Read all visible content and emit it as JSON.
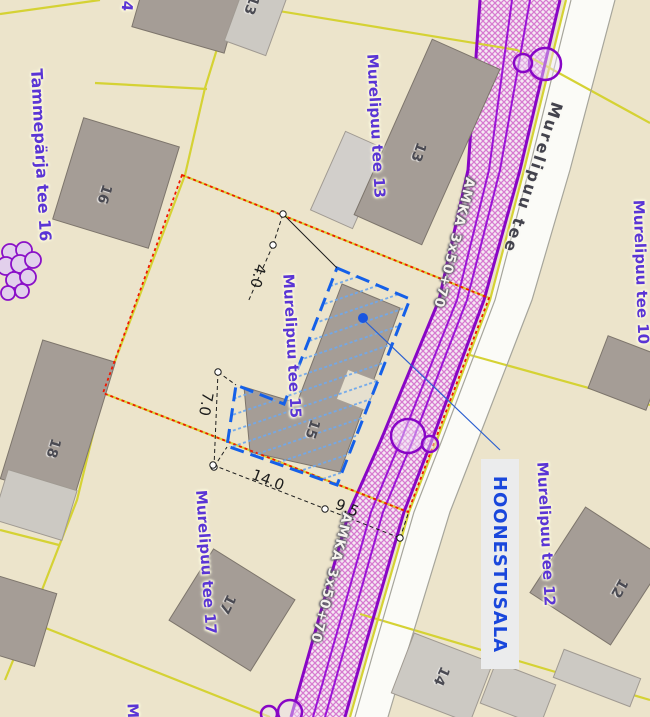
{
  "map": {
    "street_label": "Murelipuu tee",
    "cable_label_1": "AMKA 3x50+70",
    "cable_label_2": "AMKA 3x50+70",
    "annotation_label": "HOONESTUSALA",
    "plot_labels": {
      "tammeparja_16": "Tammepärja tee 16",
      "murelipuu_13": "Murelipuu tee 13",
      "murelipuu_15": "Murelipuu tee 15",
      "murelipuu_17": "Murelipuu tee 17",
      "murelipuu_10": "Murelipuu tee 10",
      "murelipuu_12": "Murelipuu tee 12",
      "partial_top": "4",
      "partial_bottom": "Mu"
    },
    "building_numbers": {
      "b16": "16",
      "b13": "13",
      "b13_top": "13",
      "b18": "18",
      "b15": "15",
      "b17": "17",
      "b12": "12",
      "b14": "14"
    },
    "dimensions": {
      "top": "4.0",
      "left": "7.0",
      "bottom_left": "14.0",
      "bottom_right": "9.5"
    }
  },
  "colors": {
    "background": "#ece4cb",
    "parcel_line_yellow": "#d5d234",
    "plan_boundary_red": "#f01800",
    "utility_corridor_purple": "#8806c6",
    "building_area_blue": "#1560e8",
    "building_area_hatch": "#6fa8ec",
    "plot_label_purple": "#5a35d5",
    "annotation_blue": "#1947dc",
    "building_fill": "#a59d96",
    "building_fill_light": "#ccc9c3",
    "road_fill": "#fbfbf7",
    "street_label_grey": "#43434d",
    "dimension_black": "#1c1c1c"
  }
}
